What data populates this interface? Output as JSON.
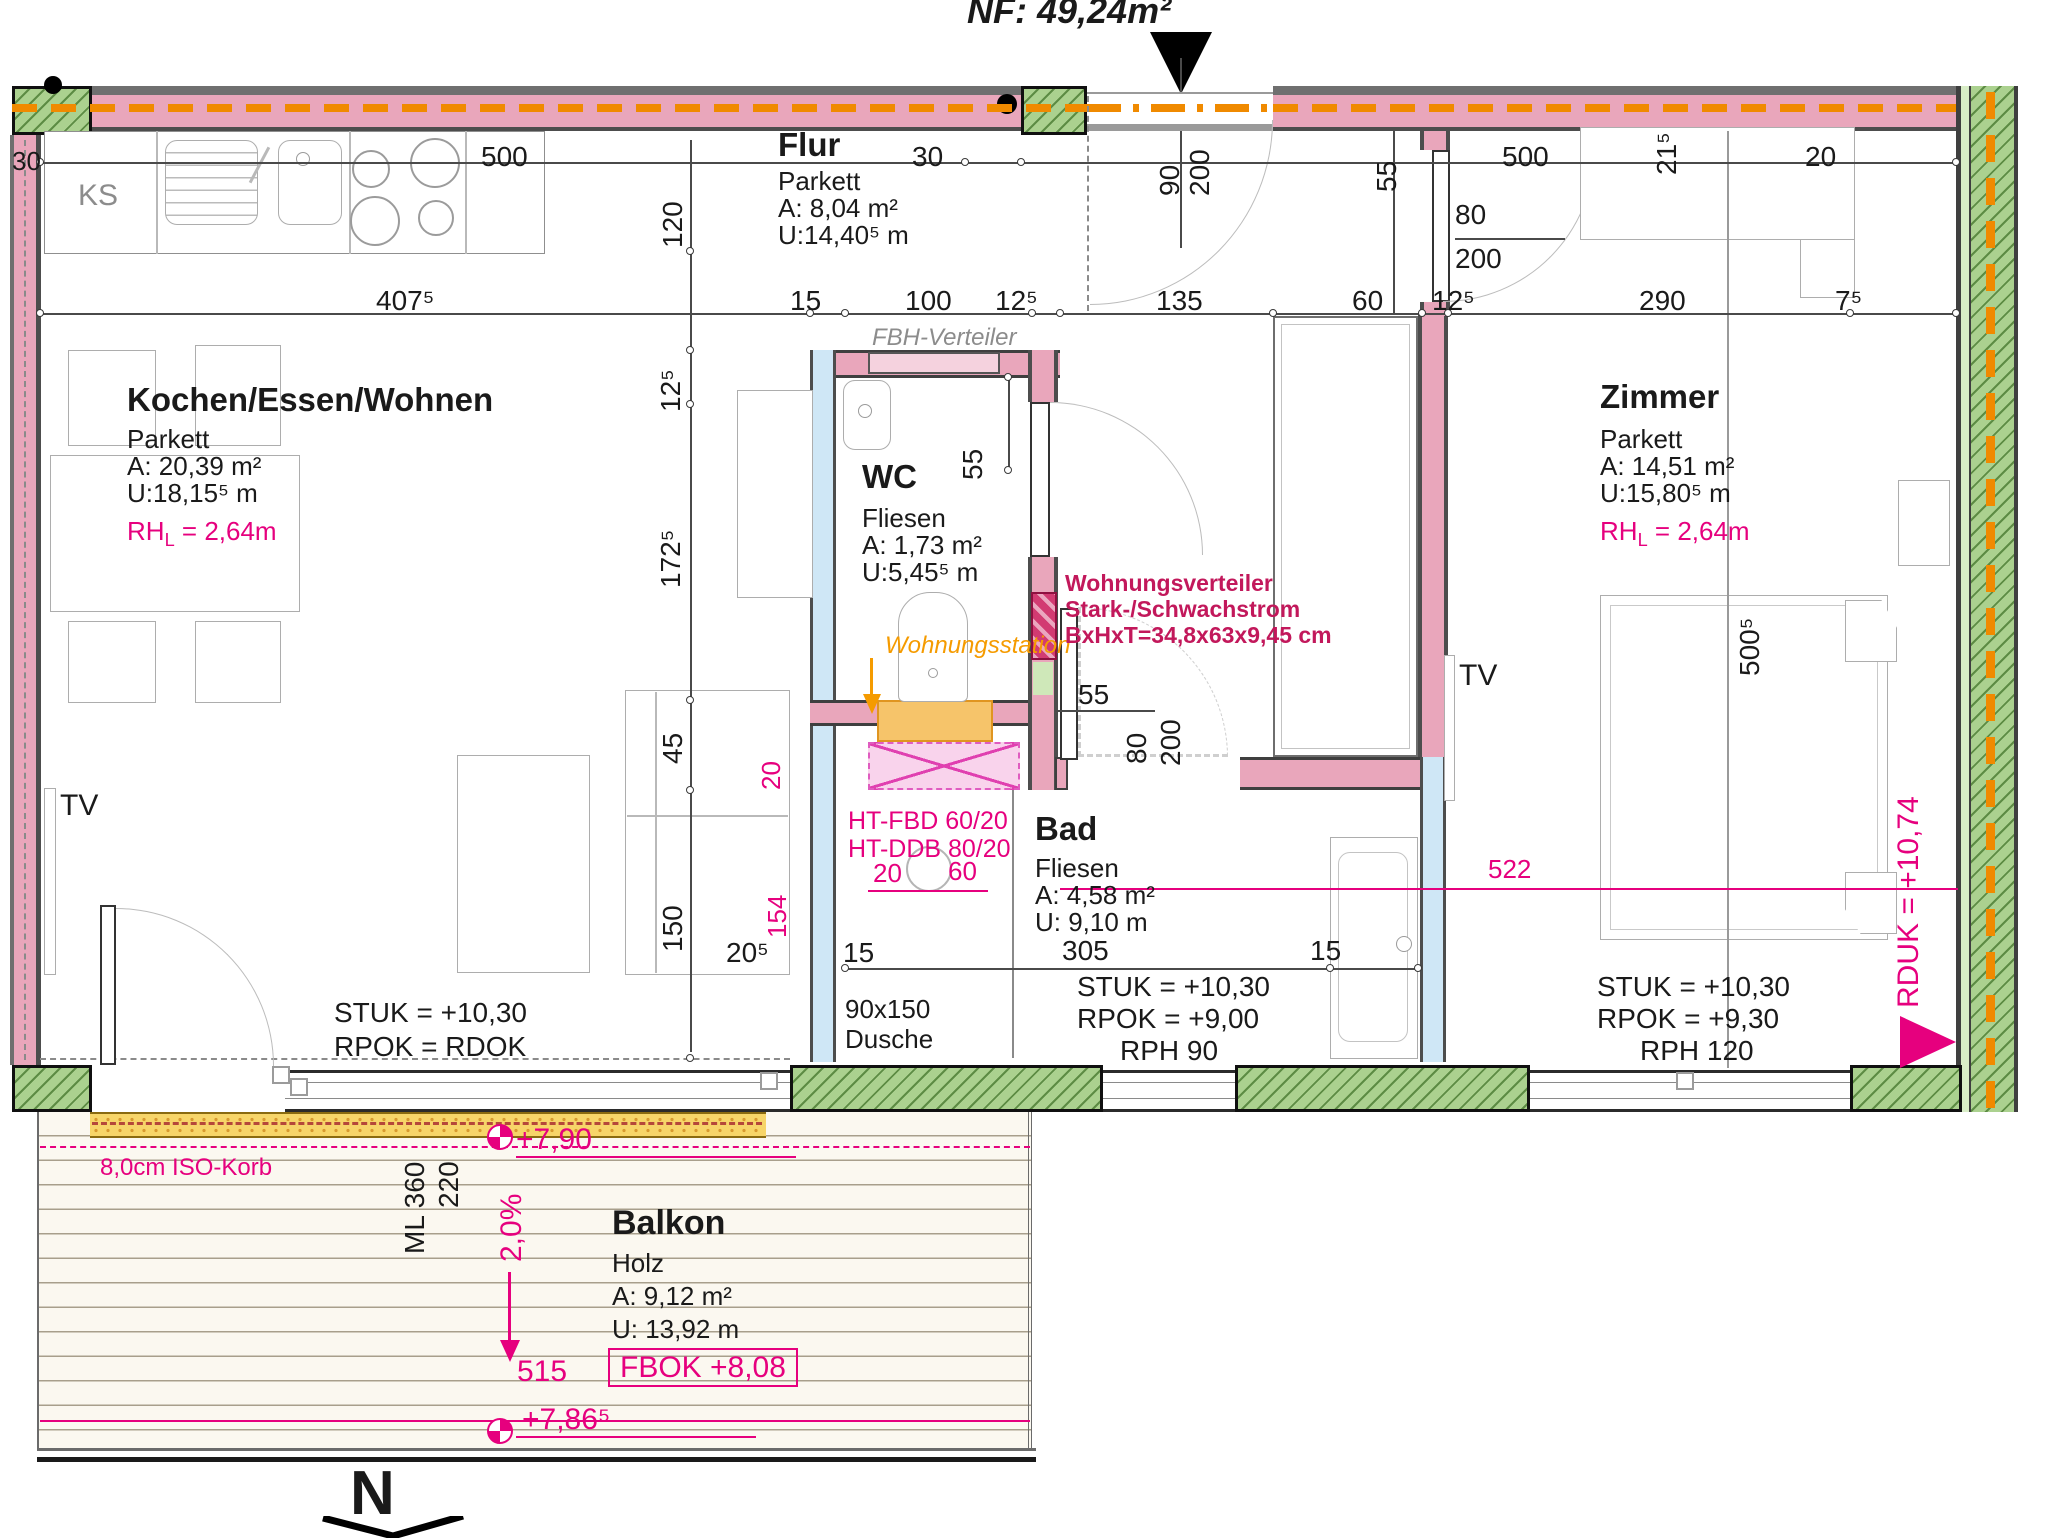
{
  "title": {
    "nf_area": "NF: 49,24m²"
  },
  "rooms": {
    "flur": {
      "name": "Flur",
      "floor": "Parkett",
      "area": "A:  8,04 m²",
      "perimeter": "U:14,40⁵ m"
    },
    "wohnen": {
      "name": "Kochen/Essen/Wohnen",
      "floor": "Parkett",
      "area": "A: 20,39 m²",
      "perimeter": "U:18,15⁵ m",
      "rh_prefix": "RH",
      "rh_sub": "L",
      "rh_value": " = 2,64m"
    },
    "wc": {
      "name": "WC",
      "floor": "Fliesen",
      "area": "A:  1,73 m²",
      "perimeter": "U:5,45⁵ m"
    },
    "bad": {
      "name": "Bad",
      "floor": "Fliesen",
      "area": "A:  4,58 m²",
      "perimeter": "U: 9,10 m"
    },
    "zimmer": {
      "name": "Zimmer",
      "floor": "Parkett",
      "area": "A: 14,51 m²",
      "perimeter": "U:15,80⁵ m",
      "rh_prefix": "RH",
      "rh_sub": "L",
      "rh_value": " = 2,64m"
    },
    "balkon": {
      "name": "Balkon",
      "floor": "Holz",
      "area": "A:  9,12 m²",
      "perimeter": "U: 13,92 m"
    }
  },
  "levels": {
    "wohnen_stuk": "STUK = +10,30",
    "wohnen_rpok": "RPOK = RDOK",
    "bad_stuk": "STUK = +10,30",
    "bad_rpok": "RPOK = +9,00",
    "bad_rph": "RPH  90",
    "zimmer_stuk": "STUK = +10,30",
    "zimmer_rpok": "RPOK = +9,30",
    "zimmer_rph": "RPH  120",
    "rduk": "RDUK = +10,74",
    "fbok": "FBOK +8,08",
    "lvl_790": "+7,90",
    "lvl_7865": "+7,86⁵",
    "slope": "2,0%"
  },
  "notes": {
    "fbh": "FBH-Verteiler",
    "wst": "Wohnungsstation",
    "wvt1": "Wohnungsverteiler",
    "wvt2": "Stark-/Schwachstrom",
    "wvt3": "BxHxT=34,8x63x9,45 cm",
    "ht1": "HT-FBD 60/20",
    "ht2": "HT-DDB 80/20",
    "iso": "8,0cm ISO-Korb",
    "dusche1": "90x150",
    "dusche2": "Dusche",
    "ks": "KS",
    "tv": "TV",
    "tv2": "TV",
    "north": "N"
  },
  "dims": {
    "d30_left": "30",
    "d500_k": "500",
    "d30_entry": "30",
    "d90": "90",
    "d200": "200",
    "d55_flur": "55",
    "d500_z": "500",
    "d215": "21⁵",
    "d20_tr": "20",
    "d120": "120",
    "d4075": "407⁵",
    "d15": "15",
    "d100": "100",
    "d125a": "12⁵",
    "d135": "135",
    "d60": "60",
    "d125b": "12⁵",
    "d290": "290",
    "d75": "7⁵",
    "d125l": "12⁵",
    "d1725": "172⁵",
    "d45": "45",
    "d150": "150",
    "d205": "20⁵",
    "d20m": "20",
    "d154": "154",
    "d55_wc": "55",
    "d55_bad": "55",
    "d80b": "80",
    "d200b": "200",
    "d80c": "80",
    "d200c": "200",
    "d305": "305",
    "d15a": "15",
    "d15b": "15",
    "d5005": "500⁵",
    "d522": "522",
    "d515": "515",
    "dml": "ML 360",
    "d220": "220"
  }
}
